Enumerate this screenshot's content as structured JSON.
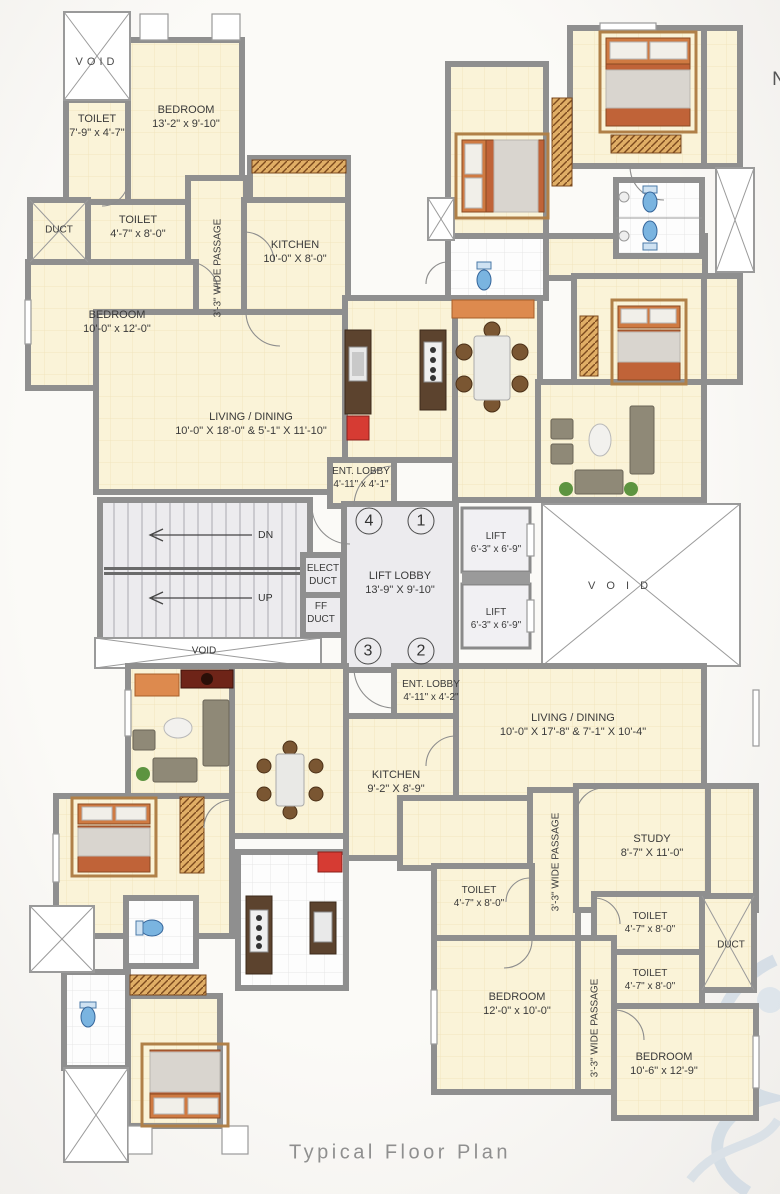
{
  "caption": "Typical Floor Plan",
  "north_letter": "N",
  "units": {
    "u1": "1",
    "u2": "2",
    "u3": "3",
    "u4": "4"
  },
  "stairs": {
    "dn": "DN",
    "up": "UP"
  },
  "rooms": {
    "void_tl": {
      "name": "VOID"
    },
    "toilet_tl": {
      "name": "TOILET",
      "dim": "7'-9\" x 4'-7\""
    },
    "bedroom_tl": {
      "name": "BEDROOM",
      "dim": "13'-2\" x 9'-10\""
    },
    "duct_l": {
      "name": "DUCT"
    },
    "toilet_l2": {
      "name": "TOILET",
      "dim": "4'-7\" x 8'-0\""
    },
    "kitchen_tl": {
      "name": "KITCHEN",
      "dim": "10'-0\" X 8'-0\""
    },
    "passage_tl": {
      "name": "3'-3\" WIDE PASSAGE"
    },
    "bedroom_l2": {
      "name": "BEDROOM",
      "dim": "10'-0\" x 12'-0\""
    },
    "living_tl": {
      "name": "LIVING / DINING",
      "dim": "10'-0\" X 18'-0\" & 5'-1\" X 11'-10\""
    },
    "ent_lobby_t": {
      "name": "ENT. LOBBY",
      "dim": "4'-11\" x 4'-1\""
    },
    "elect_duct": {
      "name": "ELECT",
      "dim": "DUCT"
    },
    "ff_duct": {
      "name": "FF",
      "dim": "DUCT"
    },
    "lift_lobby": {
      "name": "LIFT LOBBY",
      "dim": "13'-9\" X 9'-10\""
    },
    "lift_1": {
      "name": "LIFT",
      "dim": "6'-3\" x 6'-9\""
    },
    "lift_2": {
      "name": "LIFT",
      "dim": "6'-3\" x 6'-9\""
    },
    "void_center": {
      "name": "VOID"
    },
    "void_right": {
      "name": "V O I D"
    },
    "ent_lobby_b": {
      "name": "ENT. LOBBY",
      "dim": "4'-11\" x 4'-2\""
    },
    "living_b": {
      "name": "LIVING / DINING",
      "dim": "10'-0\" X 17'-8\" & 7'-1\" X 10'-4\""
    },
    "kitchen_b": {
      "name": "KITCHEN",
      "dim": "9'-2\" X 8'-9\""
    },
    "study": {
      "name": "STUDY",
      "dim": "8'-7\" X 11'-0\""
    },
    "toilet_b1": {
      "name": "TOILET",
      "dim": "4'-7\" x 8'-0\""
    },
    "passage_b1": {
      "name": "3'-3\" WIDE PASSAGE"
    },
    "toilet_br1": {
      "name": "TOILET",
      "dim": "4'-7\" x 8'-0\""
    },
    "duct_r": {
      "name": "DUCT"
    },
    "toilet_br2": {
      "name": "TOILET",
      "dim": "4'-7\" x 8'-0\""
    },
    "bedroom_b1": {
      "name": "BEDROOM",
      "dim": "12'-0\" x 10'-0\""
    },
    "passage_b2": {
      "name": "3'-3\" WIDE PASSAGE"
    },
    "bedroom_br": {
      "name": "BEDROOM",
      "dim": "10'-6\" x 12'-9\""
    }
  },
  "colors": {
    "room_fill": "#faf3d8",
    "wall": "#8f8f8f",
    "accent_red": "#d63b33",
    "fixture_blue": "#7ab4e0",
    "counter_orange": "#dd8a4e",
    "caption_gray": "#8f8f8f"
  }
}
